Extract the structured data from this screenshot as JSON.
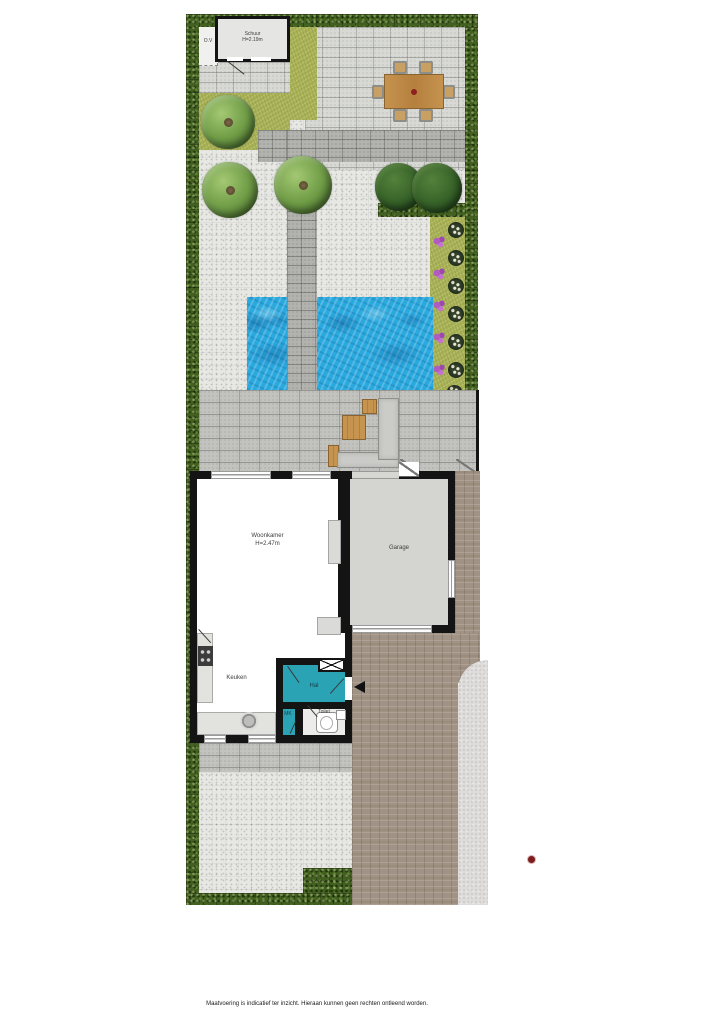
{
  "floorplan": {
    "shed": {
      "name": "Schuur",
      "height": "H=2.19m"
    },
    "storage_label": "O.V",
    "rooms": {
      "living_room": {
        "name": "Woonkamer",
        "height": "H=2.47m"
      },
      "garage": {
        "name": "Garage"
      },
      "kitchen": {
        "name": "Keuken"
      },
      "hall": {
        "name": "Hal"
      },
      "meter_cupboard": {
        "name": "MK"
      },
      "toilet": {
        "name": "Toilet"
      }
    },
    "disclaimer": "Maatvoering is indicatief ter inzicht. Hieraan kunnen geen rechten ontleend worden.",
    "colors": {
      "hedge_green": "#42601f",
      "grass_olive": "#a9b258",
      "pond_blue": "#2aa9df",
      "hall_floor_teal": "#2aa3b5",
      "brick_drive": "#a09284",
      "wall_black": "#141414",
      "wood_brown": "#c6944f",
      "marker_red": "#7c1c1c"
    }
  }
}
